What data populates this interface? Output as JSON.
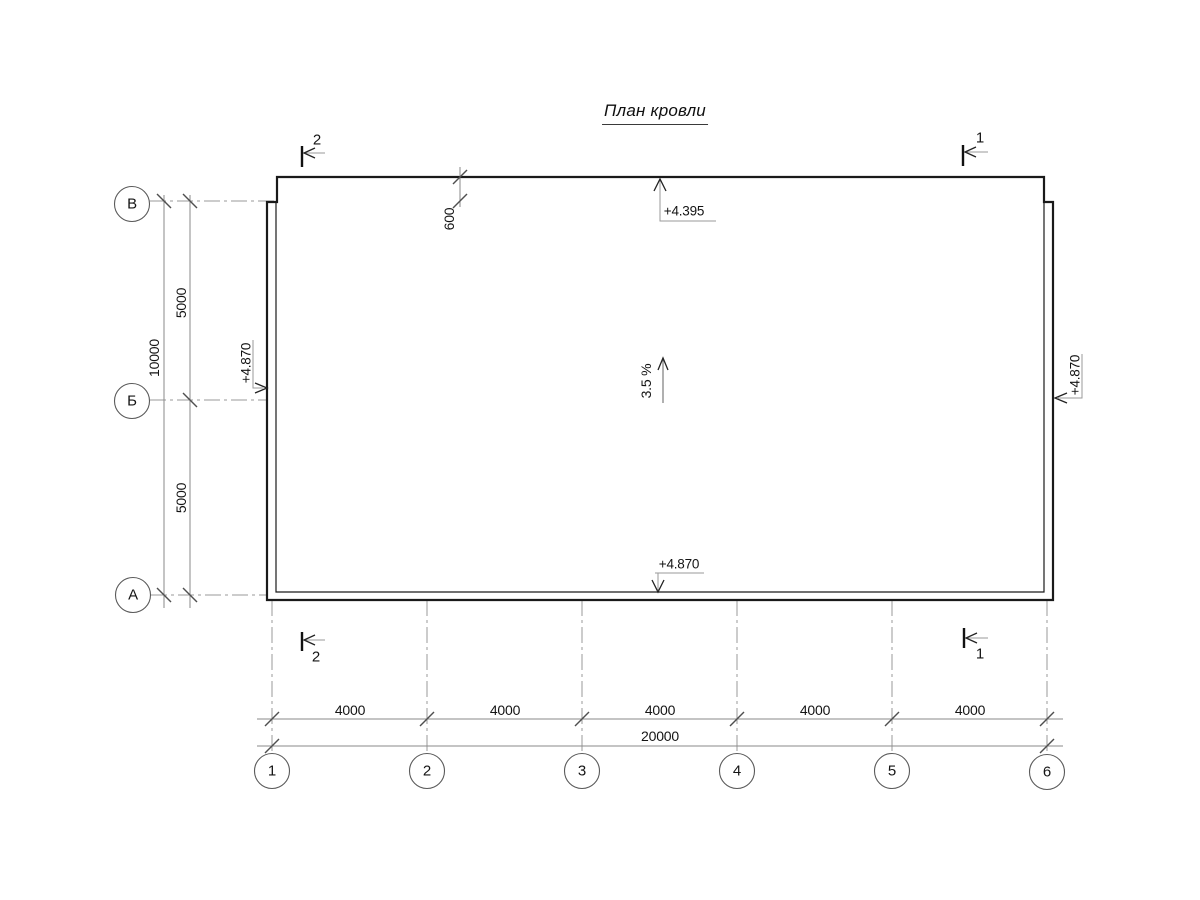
{
  "title": "План кровли",
  "grid": {
    "columns": [
      "1",
      "2",
      "3",
      "4",
      "5",
      "6"
    ],
    "rows": [
      "В",
      "Б",
      "А"
    ]
  },
  "dims": {
    "col": [
      "4000",
      "4000",
      "4000",
      "4000",
      "4000"
    ],
    "col_total": "20000",
    "row": [
      "5000",
      "5000"
    ],
    "row_total": "10000",
    "overhang": "600"
  },
  "elevations": {
    "top": "+4.395",
    "bottom": "+4.870",
    "left": "+4.870",
    "right": "+4.870"
  },
  "slope": "3.5 %",
  "sections": {
    "top_left": "2",
    "top_right": "1",
    "bottom_left": "2",
    "bottom_right": "1"
  },
  "colors": {
    "outline": "#1a1a1a",
    "axis_line": "#9a9a9a",
    "dim_line": "#8a8a8a",
    "tick": "#4f4f4f"
  }
}
